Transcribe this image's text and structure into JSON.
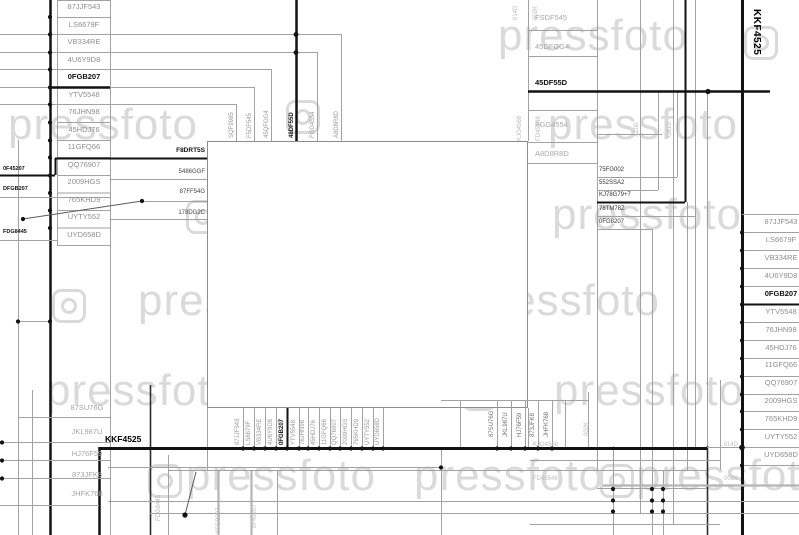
{
  "title_right": "KKF4525",
  "title_bottom": "KKF4525",
  "watermark": {
    "text": "pressfoto",
    "texts": [
      [
        498,
        12
      ],
      [
        8,
        101
      ],
      [
        548,
        101
      ],
      [
        552,
        191
      ],
      [
        138,
        277
      ],
      [
        470,
        277
      ],
      [
        46,
        367
      ],
      [
        554,
        367
      ],
      [
        186,
        452
      ],
      [
        414,
        452
      ],
      [
        636,
        452
      ]
    ],
    "logos": [
      [
        286,
        100
      ],
      [
        186,
        200
      ],
      [
        52,
        289
      ],
      [
        462,
        377
      ],
      [
        148,
        464
      ],
      [
        600,
        464
      ],
      [
        744,
        26
      ]
    ]
  },
  "groups": [
    {
      "name": "left-column-label",
      "cls": "col ac",
      "items": [
        {
          "t": "87JJF543",
          "x": 84,
          "y": 3
        },
        {
          "t": "LS6679F",
          "x": 84,
          "y": 20.5
        },
        {
          "t": "VB334RE",
          "x": 84,
          "y": 38
        },
        {
          "t": "4U6Y9D8",
          "x": 84,
          "y": 55.5
        },
        {
          "t": "0FGB207",
          "x": 84,
          "y": 73,
          "cls": "colb ac"
        },
        {
          "t": "YTV5548",
          "x": 84,
          "y": 90.5
        },
        {
          "t": "76JHN98",
          "x": 84,
          "y": 108
        },
        {
          "t": "45HDJ76",
          "x": 84,
          "y": 125.5
        },
        {
          "t": "11GFQ66",
          "x": 84,
          "y": 143
        },
        {
          "t": "QQ76907",
          "x": 84,
          "y": 160.5
        },
        {
          "t": "2009HGS",
          "x": 84,
          "y": 178
        },
        {
          "t": "765KHD9",
          "x": 84,
          "y": 195.5
        },
        {
          "t": "UYTY552",
          "x": 84,
          "y": 213
        },
        {
          "t": "UYD658D",
          "x": 84,
          "y": 230.5
        }
      ]
    },
    {
      "name": "right-column-label",
      "cls": "col ac",
      "items": [
        {
          "t": "87JJF543",
          "x": 781,
          "y": 218
        },
        {
          "t": "LS6679F",
          "x": 781,
          "y": 236
        },
        {
          "t": "VB334RE",
          "x": 781,
          "y": 254
        },
        {
          "t": "4U6Y9D8",
          "x": 781,
          "y": 272
        },
        {
          "t": "0FGB207",
          "x": 781,
          "y": 289.5,
          "cls": "colb ac"
        },
        {
          "t": "YTV5548",
          "x": 781,
          "y": 307.5
        },
        {
          "t": "76JHN98",
          "x": 781,
          "y": 325.5
        },
        {
          "t": "45HDJ76",
          "x": 781,
          "y": 343.5
        },
        {
          "t": "11GFQ66",
          "x": 781,
          "y": 361
        },
        {
          "t": "QQ76907",
          "x": 781,
          "y": 379
        },
        {
          "t": "2009HGS",
          "x": 781,
          "y": 397
        },
        {
          "t": "765KHD9",
          "x": 781,
          "y": 415
        },
        {
          "t": "UYTY552",
          "x": 781,
          "y": 433
        },
        {
          "t": "UYD658D",
          "x": 781,
          "y": 450.5
        }
      ]
    },
    {
      "name": "top-pin-label",
      "cls": "pin rv",
      "items": [
        {
          "t": "SQF9985",
          "x": 228.5,
          "y": 138
        },
        {
          "t": "F5DF545",
          "x": 247,
          "y": 138
        },
        {
          "t": "45QFGG4",
          "x": 264,
          "y": 138
        },
        {
          "t": "48DF55D",
          "x": 289,
          "y": 138,
          "cls": "pinb rv"
        },
        {
          "t": "FGG4554",
          "x": 310,
          "y": 138
        },
        {
          "t": "A8D8R8D",
          "x": 334,
          "y": 138
        }
      ]
    },
    {
      "name": "bottom-pin-label",
      "cls": "pin rv",
      "items": [
        {
          "t": "87JJF543",
          "x": 234.5,
          "y": 445
        },
        {
          "t": "LS6679F",
          "x": 245.5,
          "y": 445
        },
        {
          "t": "VB334RE",
          "x": 256.5,
          "y": 445
        },
        {
          "t": "4U6Y9D8",
          "x": 267.5,
          "y": 445
        },
        {
          "t": "0FGB207",
          "x": 278.5,
          "y": 445,
          "cls": "pinb rv"
        },
        {
          "t": "YTV5548",
          "x": 290.5,
          "y": 445
        },
        {
          "t": "76JHN98",
          "x": 299.5,
          "y": 445
        },
        {
          "t": "45HDJ76",
          "x": 310.5,
          "y": 445
        },
        {
          "t": "11GFQ66",
          "x": 321.5,
          "y": 445
        },
        {
          "t": "QQ76907",
          "x": 331.5,
          "y": 445
        },
        {
          "t": "2009HGS",
          "x": 342.5,
          "y": 445
        },
        {
          "t": "765KHD9",
          "x": 353.5,
          "y": 445
        },
        {
          "t": "UYTY552",
          "x": 364.5,
          "y": 445
        },
        {
          "t": "UYD658D",
          "x": 374.5,
          "y": 445
        }
      ]
    },
    {
      "name": "mid-pin-label",
      "cls": "mid rv",
      "items": [
        {
          "t": "87SU76G",
          "x": 489,
          "y": 437
        },
        {
          "t": "JKL987U",
          "x": 503,
          "y": 437
        },
        {
          "t": "HJ76F59",
          "x": 516.5,
          "y": 437
        },
        {
          "t": "873JFK8",
          "x": 529.5,
          "y": 437
        },
        {
          "t": "JHFK768",
          "x": 543.5,
          "y": 437
        }
      ]
    },
    {
      "name": "left-row-label",
      "cls": "row ac",
      "items": [
        {
          "t": "87SU76G",
          "x": 87,
          "y": 404
        },
        {
          "t": "JKL987U",
          "x": 87,
          "y": 428
        },
        {
          "t": "HJ76F59",
          "x": 87,
          "y": 450
        },
        {
          "t": "873JFK8",
          "x": 87,
          "y": 471
        },
        {
          "t": "JHFK768",
          "x": 87,
          "y": 490
        }
      ]
    },
    {
      "name": "right-panel-label",
      "cls": "tall",
      "items": [
        {
          "t": "FSDF545",
          "x": 535,
          "y": 14
        },
        {
          "t": "45DFGG4",
          "x": 535,
          "y": 43
        },
        {
          "t": "45DF55D",
          "x": 535,
          "y": 79,
          "cls": "tallb"
        },
        {
          "t": "FGG4554",
          "x": 535,
          "y": 121
        },
        {
          "t": "A8D8R8D",
          "x": 535,
          "y": 150
        }
      ]
    },
    {
      "name": "step-label",
      "cls": "step",
      "items": [
        {
          "t": "75FG002",
          "x": 599,
          "y": 167
        },
        {
          "t": "552SSA2",
          "x": 599,
          "y": 180
        },
        {
          "t": "KJ78G79+7",
          "x": 599,
          "y": 192
        },
        {
          "t": "78TM78Z",
          "x": 599,
          "y": 206
        },
        {
          "t": "0FG8207",
          "x": 599,
          "y": 219
        }
      ]
    },
    {
      "name": "connector-label",
      "cls": "side ar",
      "items": [
        {
          "t": "F8DRT5S",
          "x": 205,
          "y": 147,
          "cls": "sideb ar"
        },
        {
          "t": "5486GGF",
          "x": 205,
          "y": 169
        },
        {
          "t": "87FF54G",
          "x": 205,
          "y": 189
        },
        {
          "t": "178DG2C",
          "x": 205,
          "y": 210
        }
      ]
    },
    {
      "name": "edge-label",
      "cls": "edge",
      "items": [
        {
          "t": "0F45207",
          "x": 3,
          "y": 165.5
        },
        {
          "t": "DFGB207",
          "x": 3,
          "y": 186
        },
        {
          "t": "FDG8445",
          "x": 3,
          "y": 229
        }
      ]
    },
    {
      "name": "ref-label",
      "cls": "gray",
      "items": [
        {
          "t": "014D",
          "x": 513,
          "y": 20,
          "cls": "grayv rv"
        },
        {
          "t": "002K",
          "x": 533,
          "y": 20,
          "cls": "grayv rv"
        },
        {
          "t": "KJG4568",
          "x": 517,
          "y": 141,
          "cls": "grayv rv"
        },
        {
          "t": "FD45648",
          "x": 536,
          "y": 141,
          "cls": "grayv rv"
        },
        {
          "t": "XZ00",
          "x": 634,
          "y": 137,
          "cls": "grayv rv"
        },
        {
          "t": "G810",
          "x": 667,
          "y": 137,
          "cls": "grayv rv"
        },
        {
          "t": "002K",
          "x": 584,
          "y": 436,
          "cls": "grayv rv"
        },
        {
          "t": "KJG4568",
          "x": 533,
          "y": 442
        },
        {
          "t": "FD45548",
          "x": 533,
          "y": 476
        },
        {
          "t": "014D",
          "x": 738,
          "y": 442,
          "cls": "gray ar"
        },
        {
          "t": "002K",
          "x": 738,
          "y": 476,
          "cls": "gray ar"
        },
        {
          "t": "FDG8445",
          "x": 156,
          "y": 521,
          "cls": "grayv rv"
        },
        {
          "t": "0FGB207",
          "x": 216,
          "y": 533,
          "cls": "grayv rv"
        },
        {
          "t": "0F45207",
          "x": 252,
          "y": 528,
          "cls": "grayv rv"
        }
      ]
    }
  ]
}
